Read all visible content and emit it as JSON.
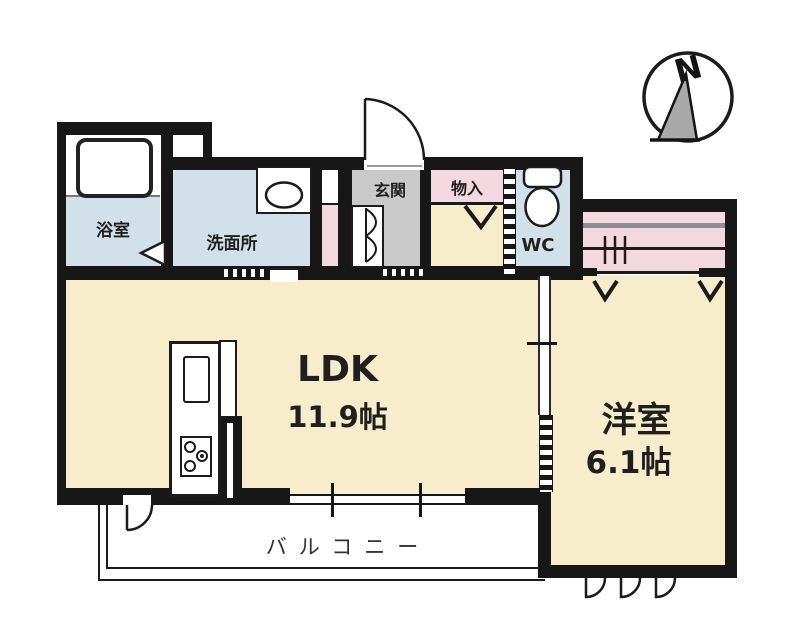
{
  "floor_plan": {
    "compass": {
      "label": "N"
    },
    "rooms": {
      "bathroom": {
        "label": "浴室"
      },
      "washroom": {
        "label": "洗面所"
      },
      "entrance": {
        "label": "玄関"
      },
      "storage": {
        "label": "物入"
      },
      "wc": {
        "label": "WC"
      },
      "ldk": {
        "label": "LDK",
        "size": "11.9帖"
      },
      "western_room": {
        "label": "洋室",
        "size": "6.1帖"
      },
      "balcony": {
        "label": "バルコニー"
      }
    },
    "colors": {
      "room_cream": "#f8edca",
      "wet_area_blue": "#d2e0ea",
      "closet_pink": "#f4d8df",
      "entrance_gray": "#c9c9c9",
      "wall_black": "#171717"
    }
  }
}
